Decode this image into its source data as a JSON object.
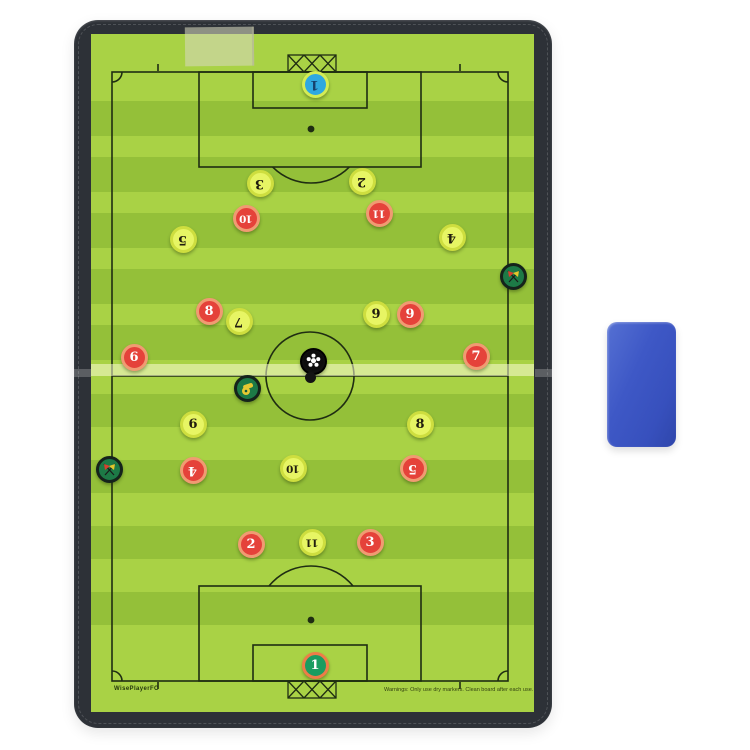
{
  "product": {
    "type_label": "magnetic folding soccer coaching board",
    "brand_text": "WisePlayerFC",
    "warning_text": "Warnings: Only use dry markers. Clean board after each use."
  },
  "board": {
    "frame_color": "#2d3137",
    "field_light_color": "#a9d245",
    "field_dark_color": "#94c039",
    "line_color": "#1f2d12"
  },
  "eraser": {
    "color": "#3e58c6"
  },
  "teams": {
    "yellow": {
      "disc": "#e7f564",
      "ring": "#cede3f",
      "number_color": "#211d0e"
    },
    "red": {
      "disc": "#e5423a",
      "ring": "#f09b72",
      "number_color": "#ffffff"
    },
    "keeper_blue": {
      "disc": "#2fa8e1",
      "ring": "#d4ec55",
      "number_color": "#16406e"
    },
    "keeper_green": {
      "disc": "#1a9c60",
      "ring": "#ee7c48",
      "number_color": "#ffffff"
    }
  },
  "magnets": [
    {
      "team": "keeper_blue",
      "number": 1,
      "x": 315,
      "y": 84,
      "flipped": true
    },
    {
      "team": "yellow",
      "number": 3,
      "x": 260,
      "y": 183,
      "flipped": true
    },
    {
      "team": "yellow",
      "number": 2,
      "x": 362,
      "y": 181,
      "flipped": true
    },
    {
      "team": "red",
      "number": 10,
      "x": 246,
      "y": 218,
      "flipped": true
    },
    {
      "team": "red",
      "number": 11,
      "x": 379,
      "y": 213,
      "flipped": true
    },
    {
      "team": "yellow",
      "number": 5,
      "x": 183,
      "y": 239,
      "flipped": true
    },
    {
      "team": "yellow",
      "number": 4,
      "x": 452,
      "y": 237,
      "flipped": true
    },
    {
      "team": "red",
      "number": 8,
      "x": 209,
      "y": 311,
      "flipped": false
    },
    {
      "team": "yellow",
      "number": 7,
      "x": 239,
      "y": 321,
      "flipped": true
    },
    {
      "team": "yellow",
      "number": 9,
      "x": 376,
      "y": 314,
      "flipped": false
    },
    {
      "team": "red",
      "number": 9,
      "x": 410,
      "y": 314,
      "flipped": false
    },
    {
      "team": "red",
      "number": 6,
      "x": 134,
      "y": 357,
      "flipped": false
    },
    {
      "team": "red",
      "number": 7,
      "x": 476,
      "y": 356,
      "flipped": false
    },
    {
      "team": "yellow",
      "number": 6,
      "x": 193,
      "y": 424,
      "flipped": false
    },
    {
      "team": "yellow",
      "number": 8,
      "x": 420,
      "y": 424,
      "flipped": false
    },
    {
      "team": "red",
      "number": 4,
      "x": 193,
      "y": 470,
      "flipped": true
    },
    {
      "team": "yellow",
      "number": 10,
      "x": 293,
      "y": 468,
      "flipped": true
    },
    {
      "team": "red",
      "number": 5,
      "x": 413,
      "y": 468,
      "flipped": true
    },
    {
      "team": "red",
      "number": 2,
      "x": 251,
      "y": 544,
      "flipped": false
    },
    {
      "team": "yellow",
      "number": 11,
      "x": 312,
      "y": 542,
      "flipped": true
    },
    {
      "team": "red",
      "number": 3,
      "x": 370,
      "y": 542,
      "flipped": false
    },
    {
      "team": "keeper_green",
      "number": 1,
      "x": 315,
      "y": 665,
      "flipped": false
    }
  ],
  "special_magnets": [
    {
      "type": "ball",
      "x": 313,
      "y": 361
    },
    {
      "type": "whistle",
      "x": 247,
      "y": 388
    },
    {
      "type": "flags",
      "x": 513,
      "y": 276
    },
    {
      "type": "flags",
      "x": 109,
      "y": 469
    }
  ]
}
